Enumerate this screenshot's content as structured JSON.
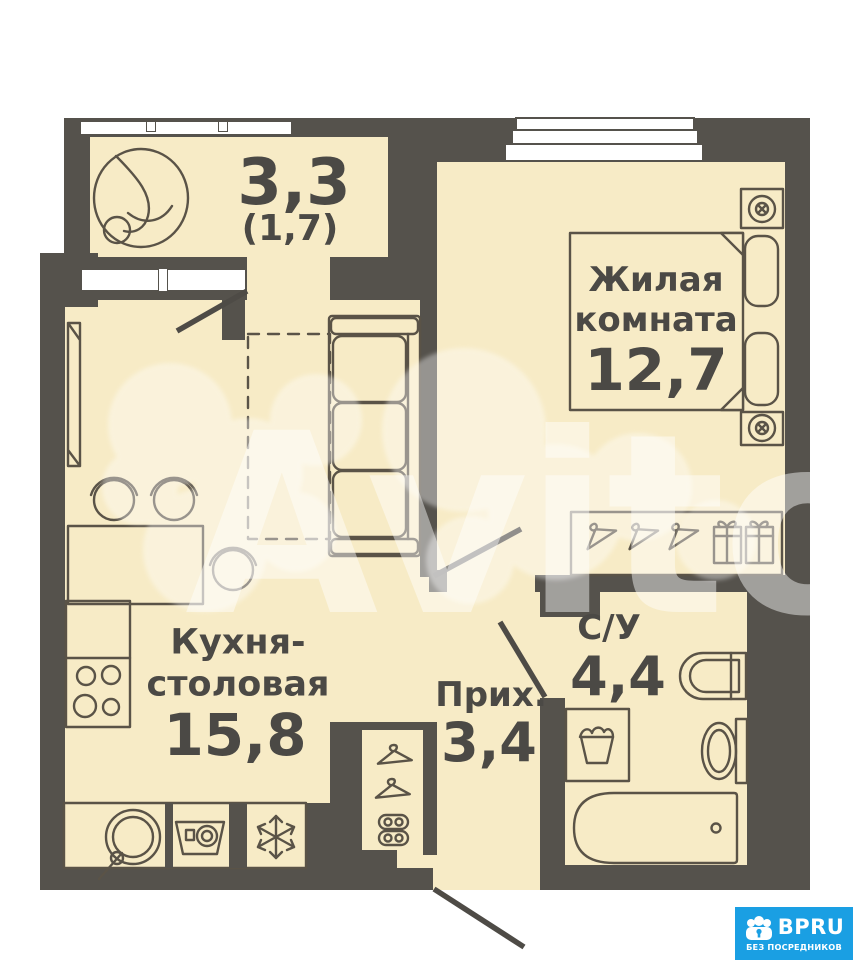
{
  "plan": {
    "balcony": {
      "area": "3,3",
      "area_alt": "(1,7)"
    },
    "living_room": {
      "line1": "Жилая",
      "line2": "комната",
      "area": "12,7"
    },
    "kitchen": {
      "line1": "Кухня-",
      "line2": "столовая",
      "area": "15,8"
    },
    "hallway": {
      "name": "Прих.",
      "area": "3,4"
    },
    "bathroom": {
      "name": "С/У",
      "area": "4,4"
    }
  },
  "watermark": {
    "text": "Avito"
  },
  "badge": {
    "brand": "BPRU",
    "tagline": "БЕЗ ПОСРЕДНИКОВ",
    "color": "#1a9fe3"
  },
  "colors": {
    "wall": "#55524c",
    "floor": "#f7ebc6",
    "outline": "#5a5347",
    "window": "#ffffff"
  }
}
